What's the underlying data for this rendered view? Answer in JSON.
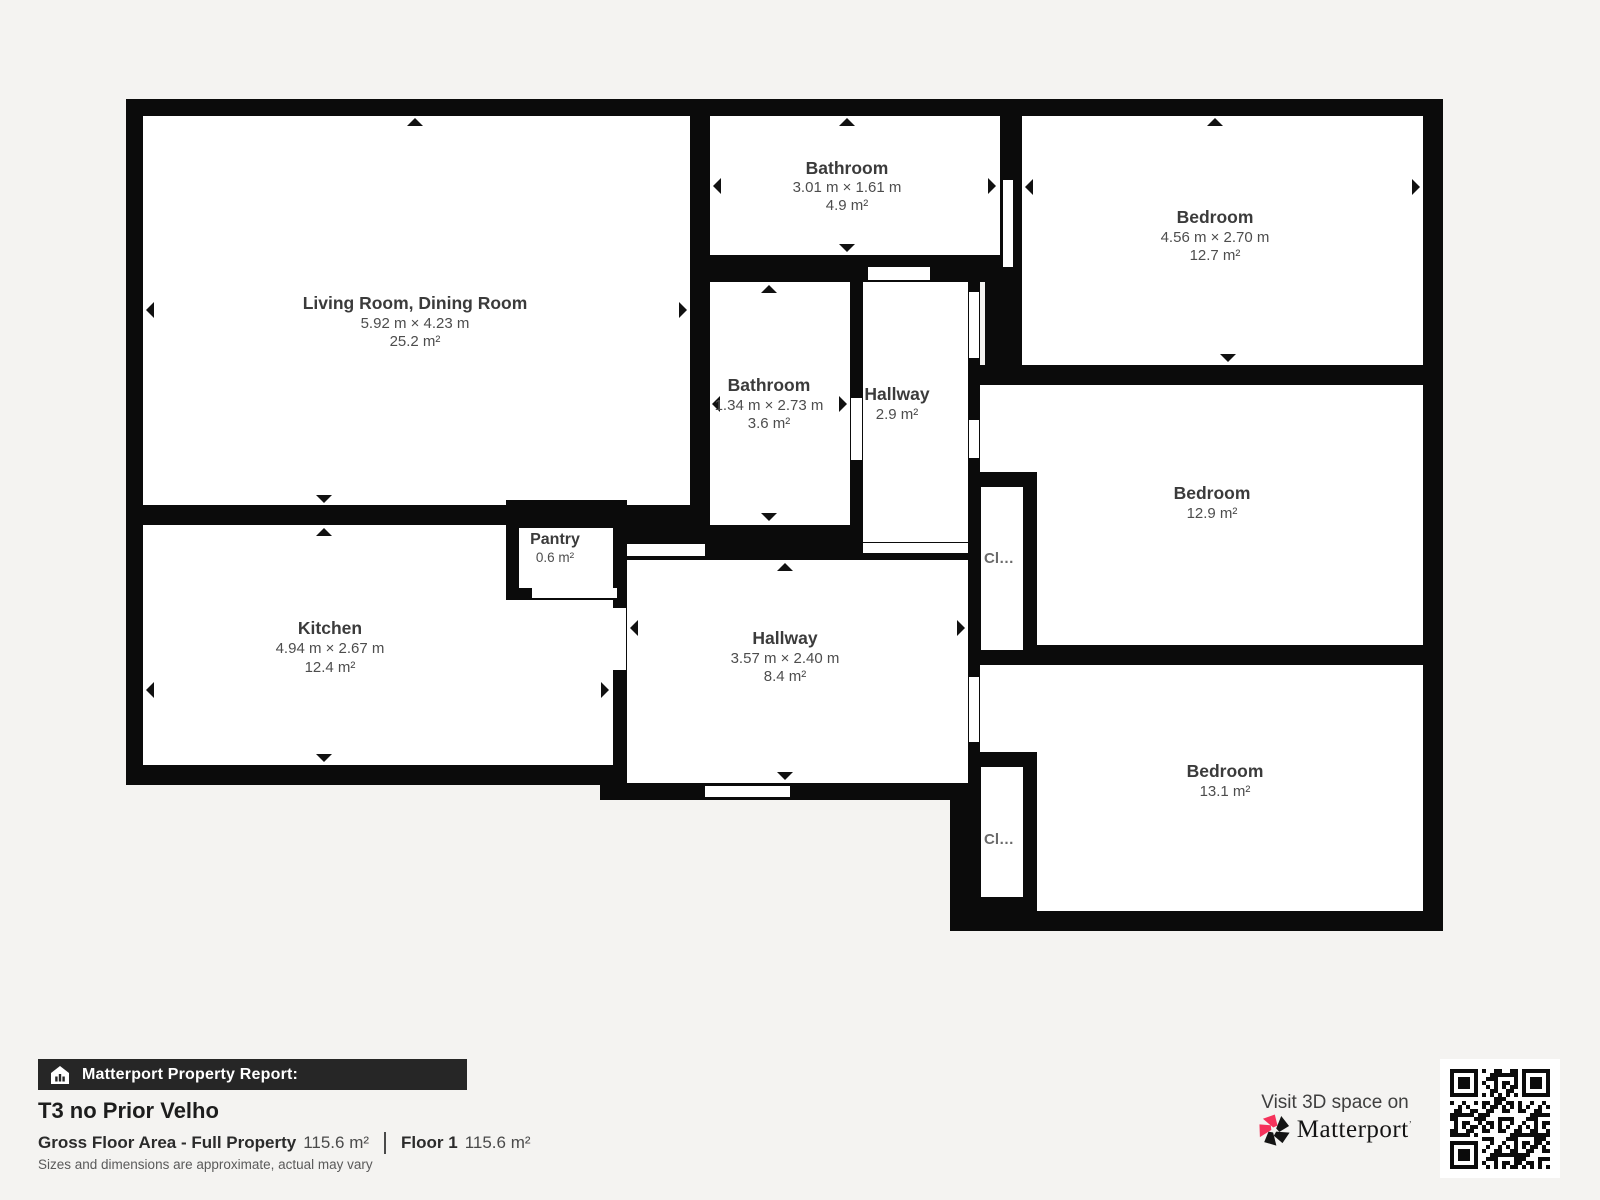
{
  "rooms": {
    "living": {
      "name": "Living Room, Dining Room",
      "dims": "5.92 m × 4.23 m",
      "area": "25.2 m²"
    },
    "bathroom_top": {
      "name": "Bathroom",
      "dims": "3.01 m × 1.61 m",
      "area": "4.9 m²"
    },
    "bedroom_top": {
      "name": "Bedroom",
      "dims": "4.56 m × 2.70 m",
      "area": "12.7 m²"
    },
    "bathroom_mid": {
      "name": "Bathroom",
      "dims": "1.34 m × 2.73 m",
      "area": "3.6 m²"
    },
    "hallway_small": {
      "name": "Hallway",
      "area": "2.9 m²"
    },
    "bedroom_mid": {
      "name": "Bedroom",
      "area": "12.9 m²"
    },
    "pantry": {
      "name": "Pantry",
      "area": "0.6 m²"
    },
    "kitchen": {
      "name": "Kitchen",
      "dims": "4.94 m × 2.67 m",
      "area": "12.4 m²"
    },
    "hallway_main": {
      "name": "Hallway",
      "dims": "3.57 m × 2.40 m",
      "area": "8.4 m²"
    },
    "bedroom_bottom": {
      "name": "Bedroom",
      "area": "13.1 m²"
    },
    "closet_mid": {
      "label": "Cl…"
    },
    "closet_bottom": {
      "label": "Cl…"
    }
  },
  "footer": {
    "report_label": "Matterport Property Report:",
    "property_title": "T3 no Prior Velho",
    "gross_label": "Gross Floor Area - Full Property",
    "gross_value": "115.6 m²",
    "floor_label": "Floor 1",
    "floor_value": "115.6 m²",
    "disclaimer": "Sizes and dimensions are approximate, actual may vary"
  },
  "branding": {
    "visit_text": "Visit 3D space on",
    "logo_text": "Matterport",
    "logo_mark": "’",
    "colors": {
      "accent_pink": "#f5325b",
      "wall": "#0b0b0b",
      "page_bg": "#f4f3f1"
    }
  }
}
